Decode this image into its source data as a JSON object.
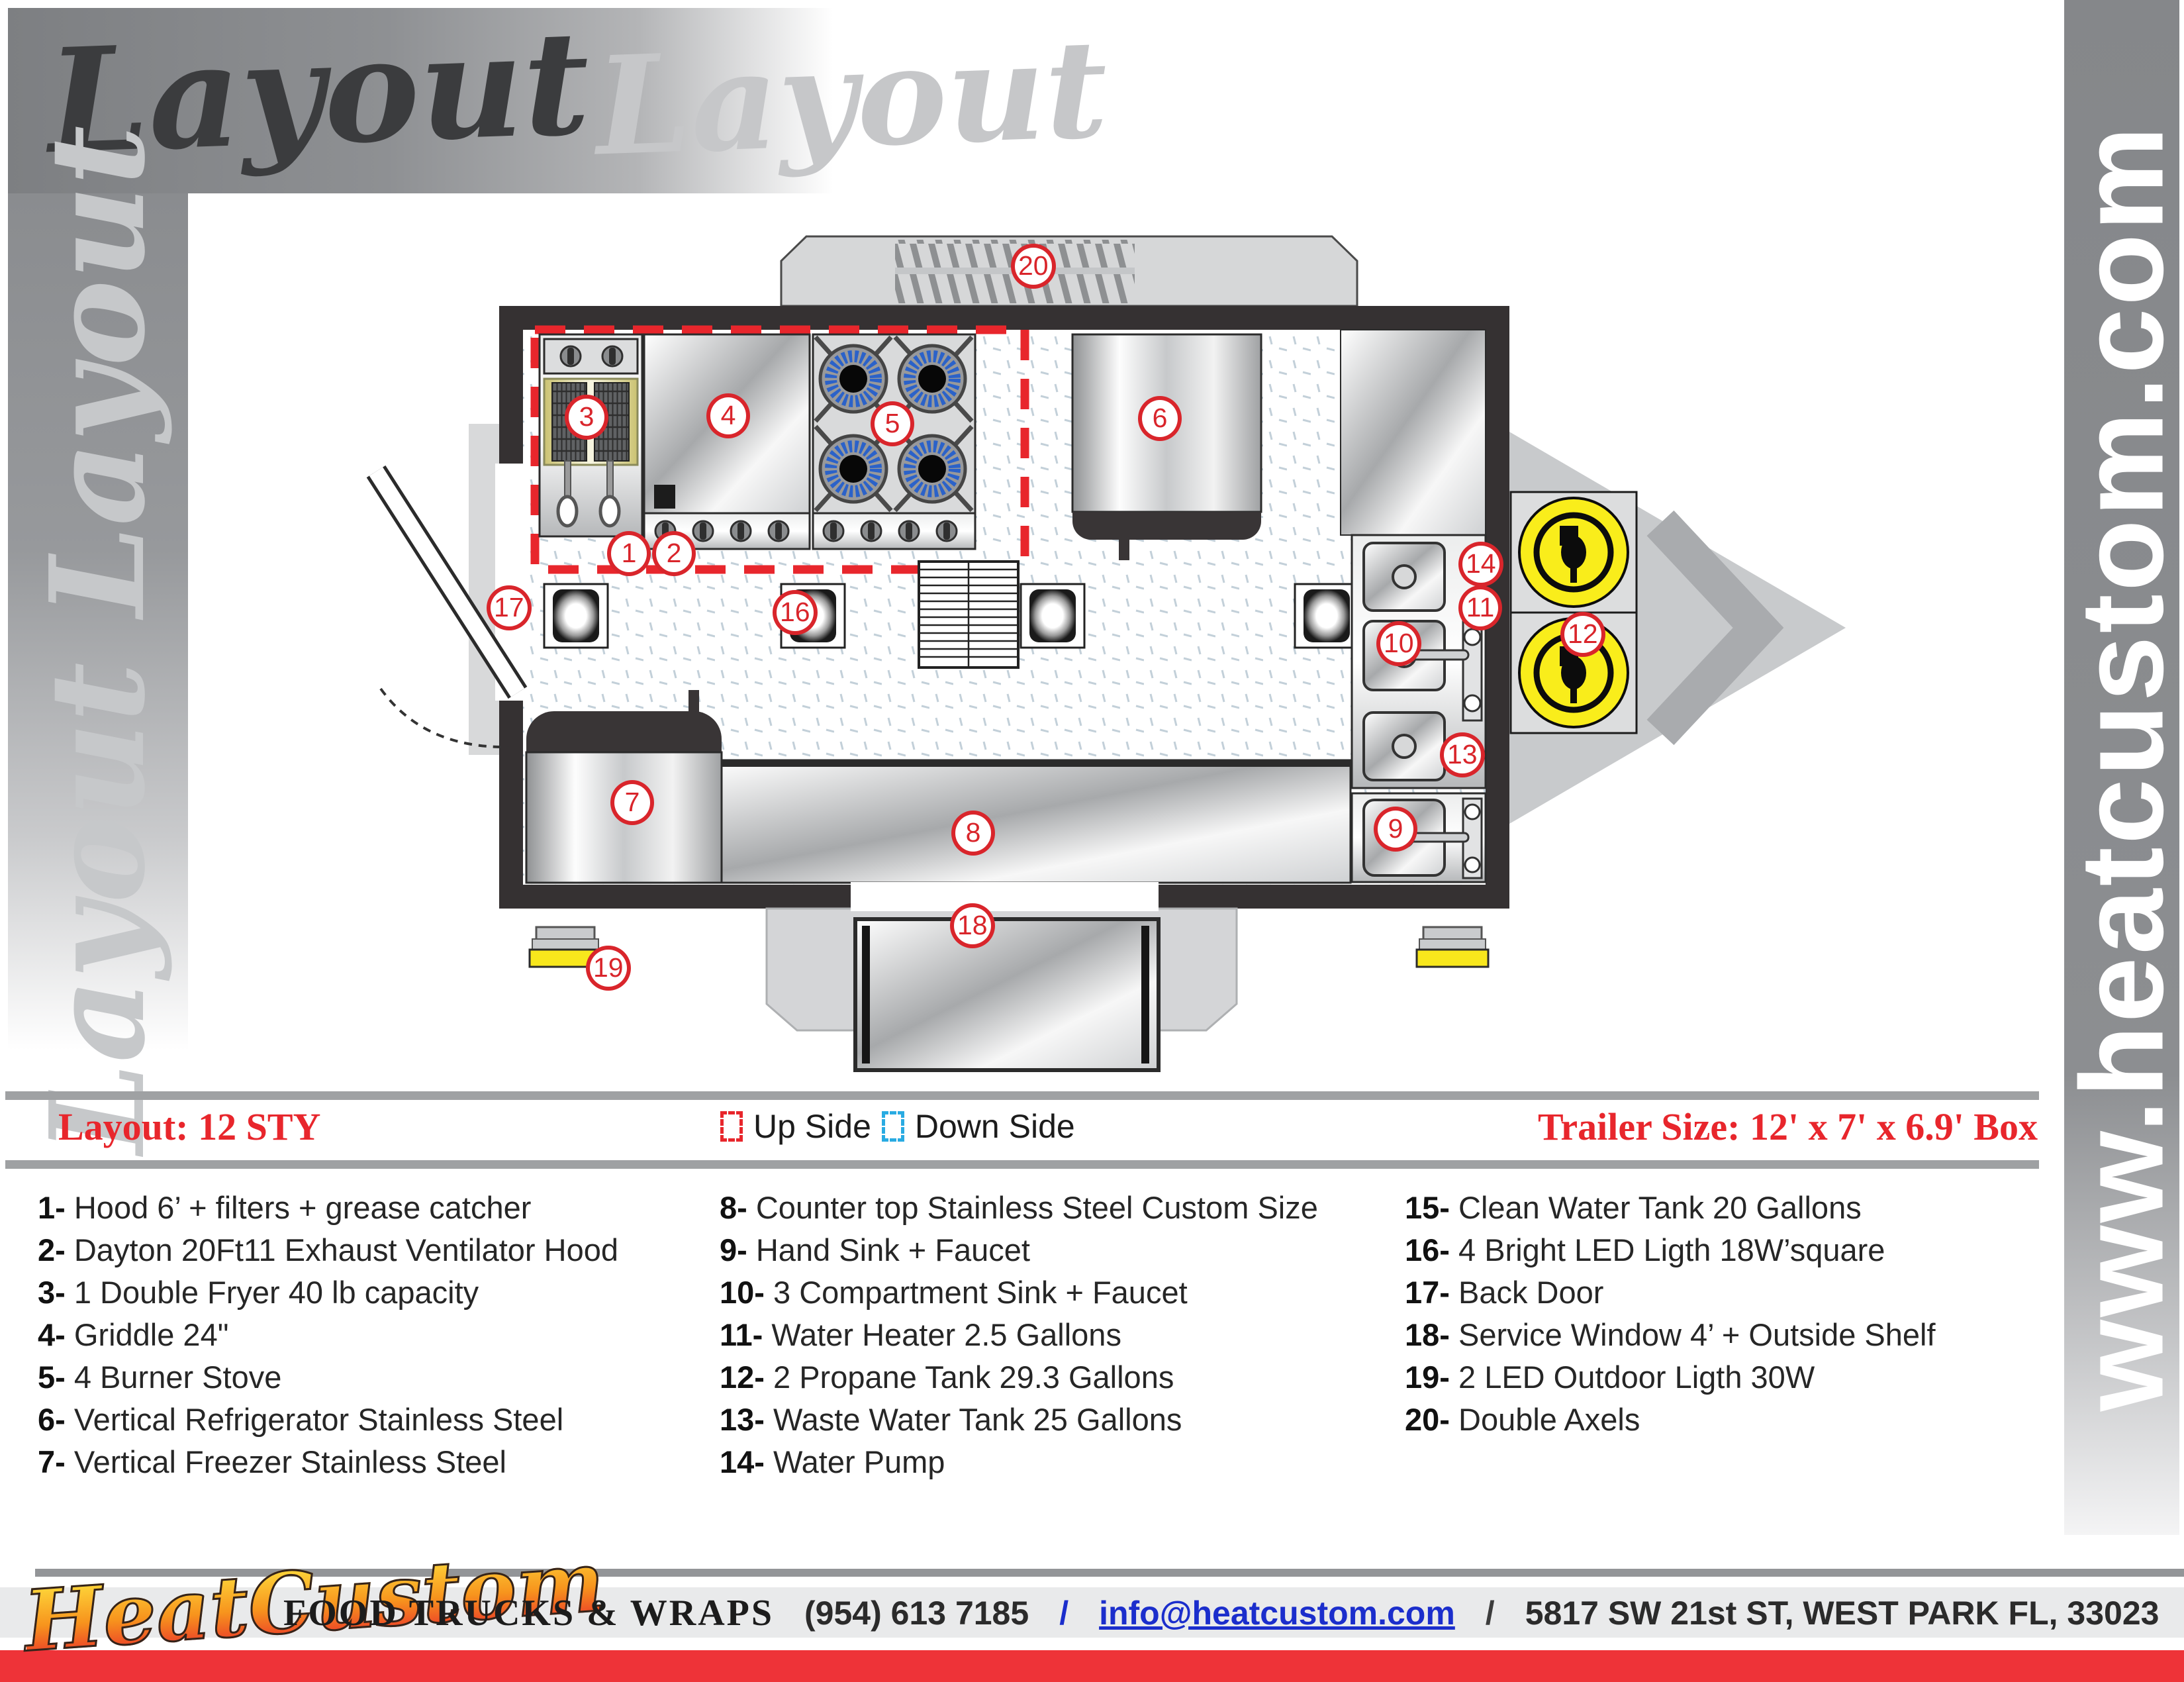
{
  "header": {
    "title_dark": "Layout",
    "title_light": "Layout",
    "side_text": "Layout Layout",
    "site_url": "www.heatcustom.com"
  },
  "legend": {
    "layout_label": "Layout: 12 STY",
    "up_side": "Up Side",
    "down_side": "Down Side",
    "trailer_size": "Trailer Size: 12' x 7' x 6.9' Box",
    "up_color": "#E8262C",
    "down_color": "#29ABE2"
  },
  "badges": {
    "b1": "1",
    "b2": "2",
    "b3": "3",
    "b4": "4",
    "b5": "5",
    "b6": "6",
    "b7": "7",
    "b8": "8",
    "b9": "9",
    "b10": "10",
    "b11": "11",
    "b12": "12",
    "b13": "13",
    "b14": "14",
    "b16": "16",
    "b17": "17",
    "b18": "18",
    "b19": "19",
    "b20": "20"
  },
  "equipment_columns": [
    [
      {
        "n": "1-",
        "t": "Hood 6’ + filters + grease catcher"
      },
      {
        "n": "2-",
        "t": "Dayton 20Ft11 Exhaust Ventilator Hood"
      },
      {
        "n": "3-",
        "t": "1 Double Fryer 40 lb capacity"
      },
      {
        "n": "4-",
        "t": "Griddle 24\""
      },
      {
        "n": "5-",
        "t": "4 Burner Stove"
      },
      {
        "n": "6-",
        "t": "Vertical Refrigerator Stainless Steel"
      },
      {
        "n": "7-",
        "t": "Vertical Freezer Stainless Steel"
      }
    ],
    [
      {
        "n": "8-",
        "t": "Counter top Stainless Steel Custom Size"
      },
      {
        "n": "9-",
        "t": "Hand Sink + Faucet"
      },
      {
        "n": "10-",
        "t": " 3 Compartment Sink + Faucet"
      },
      {
        "n": "11-",
        "t": "Water Heater 2.5 Gallons"
      },
      {
        "n": "12-",
        "t": "2 Propane Tank 29.3 Gallons"
      },
      {
        "n": "13-",
        "t": "Waste Water Tank 25 Gallons"
      },
      {
        "n": "14-",
        "t": "Water Pump"
      }
    ],
    [
      {
        "n": "15-",
        "t": "Clean Water Tank 20 Gallons"
      },
      {
        "n": "16-",
        "t": "4 Bright LED Ligth 18W’square"
      },
      {
        "n": "17-",
        "t": "Back Door"
      },
      {
        "n": "18-",
        "t": "Service Window 4’ + Outside Shelf"
      },
      {
        "n": "19-",
        "t": "2 LED Outdoor Ligth 30W"
      },
      {
        "n": "20-",
        "t": "Double Axels"
      }
    ]
  ],
  "footer": {
    "logo": "HeatCustom",
    "tagline": "FOOD TRUCKS & WRAPS",
    "phone": "(954) 613 7185",
    "sep1": "/",
    "email": "info@heatcustom.com",
    "sep2": "/",
    "address": "5817 SW 21st ST, WEST PARK FL, 33023"
  },
  "colors": {
    "accent_red": "#E8262C",
    "badge_red": "#D9252B",
    "legend_blue": "#29ABE2",
    "email_blue": "#1B2ECC",
    "wall_black": "#353132",
    "propane_yellow": "#F9ED1B",
    "bar_gray": "#8C8E90"
  }
}
